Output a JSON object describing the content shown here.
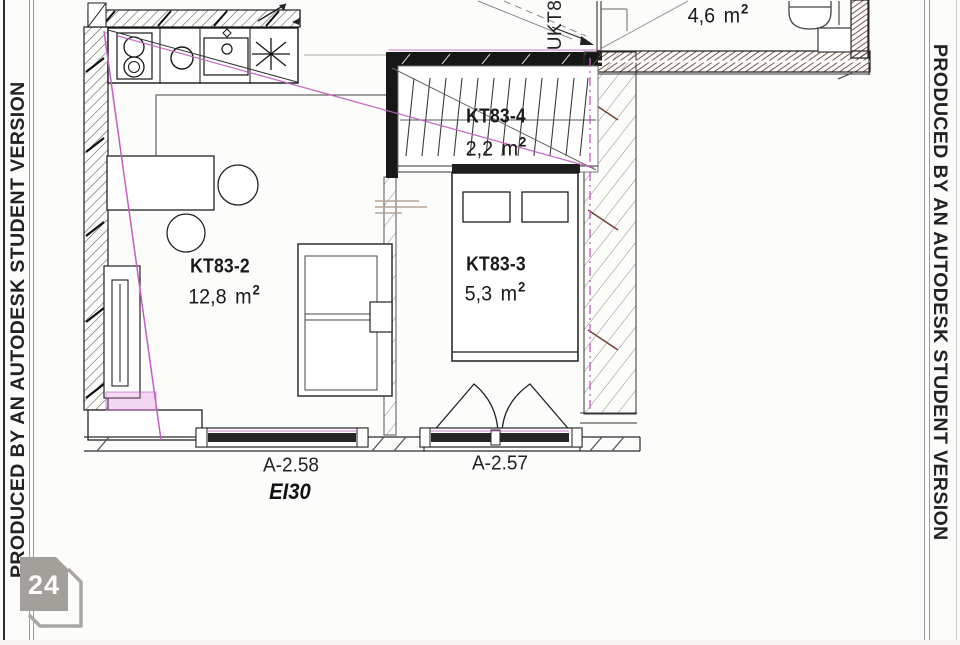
{
  "watermark": {
    "left_text": "PRODUCED BY AN AUTODESK STUDENT VERSION",
    "right_text": "PRODUCED BY AN AUTODESK STUDENT VERSION"
  },
  "page_badge": {
    "number": "24"
  },
  "plan": {
    "duct_label": "UKT8",
    "rooms": [
      {
        "id": "kt83-2",
        "name": "KT83-2",
        "area_value": "12,8",
        "area_unit": "m",
        "area_sup": "2"
      },
      {
        "id": "kt83-3",
        "name": "KT83-3",
        "area_value": "5,3",
        "area_unit": "m",
        "area_sup": "2"
      },
      {
        "id": "kt83-4",
        "name": "KT83-4",
        "area_value": "2,2",
        "area_unit": "m",
        "area_sup": "2"
      },
      {
        "id": "bathroom",
        "area_value": "4,6",
        "area_unit": "m",
        "area_sup": "2"
      }
    ],
    "openings": [
      {
        "label": "A-2.58",
        "fire_rating": "EI30"
      },
      {
        "label": "A-2.57"
      }
    ]
  },
  "colors": {
    "line": "#1d1d1d",
    "magenta": "#c25ec2",
    "wall_hatch_red": "#5a2f28",
    "badge_gray": "#a3a09c"
  }
}
